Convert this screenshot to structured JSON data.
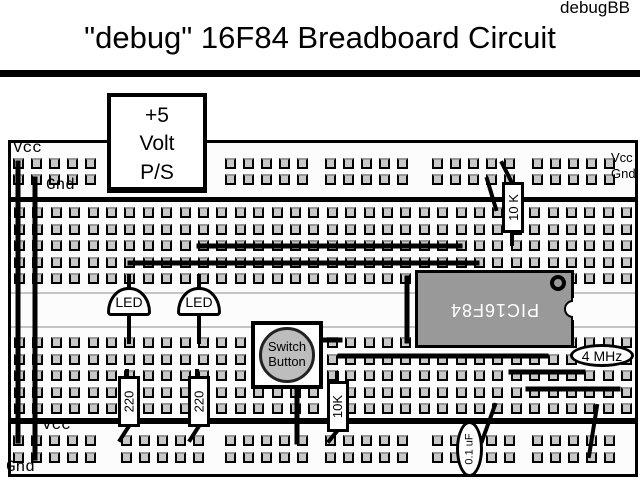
{
  "header": {
    "corner_label": "debugBB",
    "title": "\"debug\" 16F84 Breadboard Circuit"
  },
  "board": {
    "top_rail": {
      "vcc_label": "Vcc",
      "gnd_label": "Gnd"
    },
    "right_rail": {
      "vcc_label": "Vcc",
      "gnd_label": "Gnd"
    },
    "bottom_rail": {
      "vcc_label": "Vcc",
      "gnd_label": "Gnd"
    },
    "components": {
      "power_supply": {
        "line1": "+5",
        "line2": "Volt",
        "line3": "P/S"
      },
      "chip": {
        "label": "PIC16F84"
      },
      "oscillator": {
        "label": "4 MHz"
      },
      "led_left": {
        "label": "LED"
      },
      "led_right": {
        "label": "LED"
      },
      "push_switch": {
        "line1": "Switch",
        "line2": "Button"
      },
      "pullup_resistor": {
        "label": "10 K"
      },
      "resistor_led_left": {
        "label": "220"
      },
      "resistor_led_right": {
        "label": "220"
      },
      "switch_resistor": {
        "label": "10K"
      },
      "capacitor": {
        "label": "0.1 uF"
      }
    }
  },
  "colors": {
    "chip_fill": "#999999",
    "hole_fill": "#c8c8c8",
    "switch_button_fill": "#bdbdbd",
    "wire_color": "#000000"
  }
}
